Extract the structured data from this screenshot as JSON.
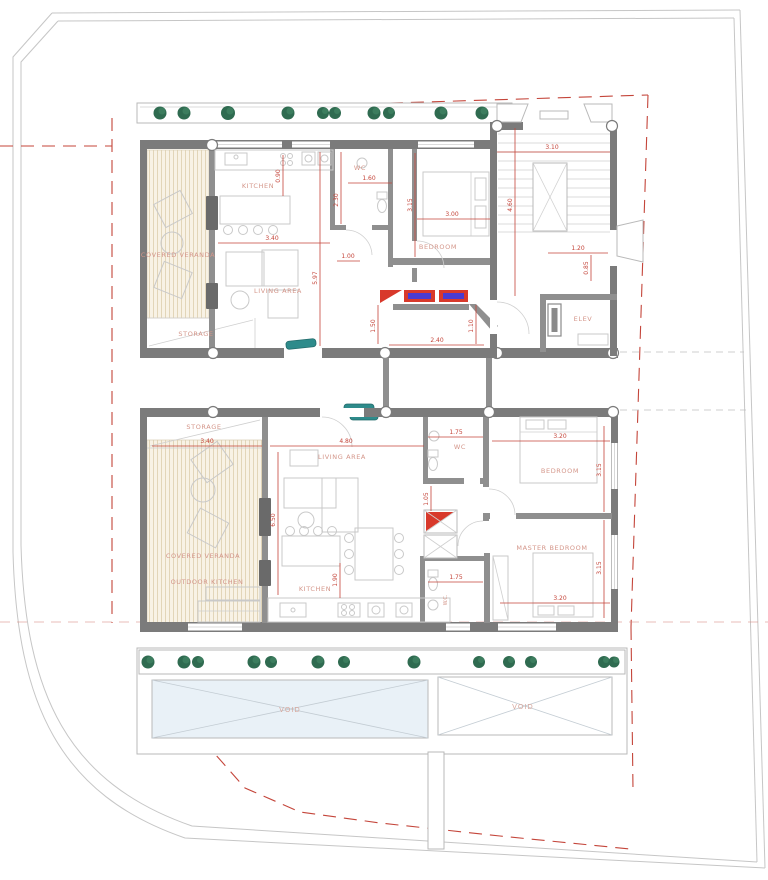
{
  "colors": {
    "wall": "#7b7b7b",
    "wall_light": "#8f8f8f",
    "dimension_red": "#c4453a",
    "room_label_salmon": "#d4968a",
    "plant_green": "#2f6b50",
    "teal_fixture": "#2e8b8b",
    "pool_blue": "#e9f1f7",
    "veranda_hatch_beige": "#f8f2e5",
    "closet_red": "#d8392b",
    "closet_blue": "#4a3bd0",
    "site_boundary_gray": "#c6c6c6"
  },
  "upper_unit": {
    "labels": {
      "covered_veranda": "COVERED VERANDA",
      "storage": "STORAGE",
      "kitchen": "KITCHEN",
      "wc": "WC",
      "living_area": "LIVING AREA",
      "bedroom": "BEDROOM",
      "elevator": "ELEV"
    },
    "dims": {
      "veranda_width": "3.40",
      "living_height": "5.97",
      "hall_width": "1.00",
      "kitchen_depth": "0.90",
      "wc_width": "1.60",
      "wc_height": "2.30",
      "bedroom_width": "3.00",
      "bedroom_height": "3.15",
      "stair_width": "3.10",
      "stair_height": "4.60",
      "elev_width": "1.20",
      "elev_height": "0.85",
      "corridor_width": "2.40",
      "corridor_height": "1.10",
      "hall_height": "1.50"
    }
  },
  "lower_unit": {
    "labels": {
      "storage": "STORAGE",
      "living_area": "LIVING AREA",
      "covered_veranda": "COVERED VERANDA",
      "outdoor_kitchen": "OUTDOOR KITCHEN",
      "kitchen": "KITCHEN",
      "wc": "WC",
      "wc_small": "W.C.",
      "bedroom": "BEDROOM",
      "master_bedroom": "MASTER BEDROOM"
    },
    "dims": {
      "veranda_width": "3.40",
      "living_width": "4.80",
      "living_height": "6.50",
      "wc_width": "1.75",
      "wc_height": "1.05",
      "bedroom_width": "3.20",
      "bedroom_height": "3.15",
      "master_width": "3.20",
      "master_height": "3.15",
      "wc2_width": "1.75",
      "kitchen_height": "1.90"
    }
  },
  "site": {
    "labels": {
      "void_left": "VOID",
      "void_right": "VOID"
    }
  }
}
